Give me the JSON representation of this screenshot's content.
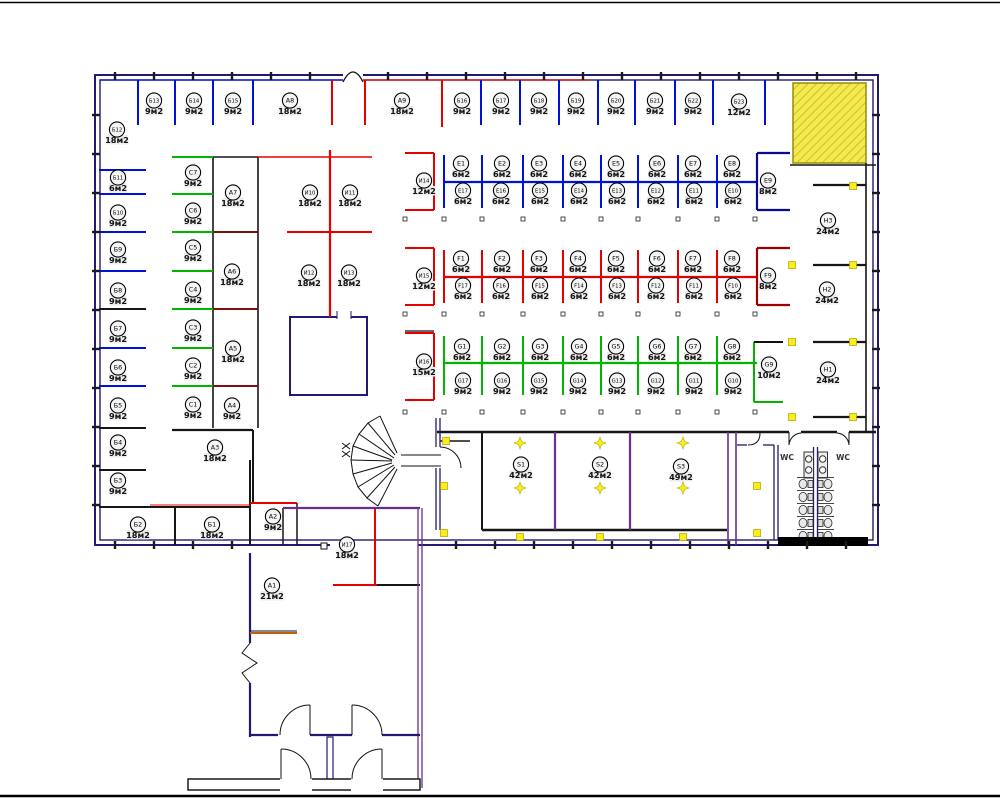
{
  "plan": {
    "wc_left_label": "WC",
    "wc_right_label": "WC",
    "colors": {
      "partition_blue": "#0012d8",
      "partition_red": "#e80000",
      "partition_green": "#00b400",
      "wall_navy": "#231a6f",
      "wall_purple": "#6b2d8f",
      "hatch_yellow": "#f2ea4e",
      "marker_yellow": "#f8ef18"
    },
    "rooms": [
      {
        "id": "Б13",
        "area": "9м2"
      },
      {
        "id": "Б14",
        "area": "9м2"
      },
      {
        "id": "Б15",
        "area": "9м2"
      },
      {
        "id": "A8",
        "area": "18м2"
      },
      {
        "id": "A9",
        "area": "18м2"
      },
      {
        "id": "Б16",
        "area": "9м2"
      },
      {
        "id": "Б17",
        "area": "9м2"
      },
      {
        "id": "Б18",
        "area": "9м2"
      },
      {
        "id": "Б19",
        "area": "9м2"
      },
      {
        "id": "Б20",
        "area": "9м2"
      },
      {
        "id": "Б21",
        "area": "9м2"
      },
      {
        "id": "Б22",
        "area": "9м2"
      },
      {
        "id": "Б23",
        "area": "12м2"
      },
      {
        "id": "Б12",
        "area": "18м2"
      },
      {
        "id": "Б11",
        "area": "6м2"
      },
      {
        "id": "Б10",
        "area": "9м2"
      },
      {
        "id": "Б9",
        "area": "9м2"
      },
      {
        "id": "Б8",
        "area": "9м2"
      },
      {
        "id": "Б7",
        "area": "9м2"
      },
      {
        "id": "Б6",
        "area": "9м2"
      },
      {
        "id": "Б5",
        "area": "9м2"
      },
      {
        "id": "Б4",
        "area": "9м2"
      },
      {
        "id": "Б3",
        "area": "9м2"
      },
      {
        "id": "Б2",
        "area": "18м2"
      },
      {
        "id": "Б1",
        "area": "18м2"
      },
      {
        "id": "C7",
        "area": "9м2"
      },
      {
        "id": "C6",
        "area": "9м2"
      },
      {
        "id": "C5",
        "area": "9м2"
      },
      {
        "id": "C4",
        "area": "9м2"
      },
      {
        "id": "C3",
        "area": "9м2"
      },
      {
        "id": "C2",
        "area": "9м2"
      },
      {
        "id": "C1",
        "area": "9м2"
      },
      {
        "id": "A7",
        "area": "18м2"
      },
      {
        "id": "A6",
        "area": "18м2"
      },
      {
        "id": "A5",
        "area": "18м2"
      },
      {
        "id": "A4",
        "area": "9м2"
      },
      {
        "id": "A3",
        "area": "18м2"
      },
      {
        "id": "A2",
        "area": "9м2"
      },
      {
        "id": "A1",
        "area": "21м2"
      },
      {
        "id": "И10",
        "area": "18м2"
      },
      {
        "id": "И11",
        "area": "18м2"
      },
      {
        "id": "И12",
        "area": "18м2"
      },
      {
        "id": "И13",
        "area": "18м2"
      },
      {
        "id": "И14",
        "area": "12м2"
      },
      {
        "id": "И15",
        "area": "12м2"
      },
      {
        "id": "И16",
        "area": "15м2"
      },
      {
        "id": "И17",
        "area": "18м2"
      },
      {
        "id": "E1",
        "area": "6м2"
      },
      {
        "id": "E2",
        "area": "6м2"
      },
      {
        "id": "E3",
        "area": "6м2"
      },
      {
        "id": "E4",
        "area": "6м2"
      },
      {
        "id": "E5",
        "area": "6м2"
      },
      {
        "id": "E6",
        "area": "6м2"
      },
      {
        "id": "E7",
        "area": "6м2"
      },
      {
        "id": "E8",
        "area": "6м2"
      },
      {
        "id": "E9",
        "area": "8м2"
      },
      {
        "id": "E17",
        "area": "6м2"
      },
      {
        "id": "E16",
        "area": "6м2"
      },
      {
        "id": "E15",
        "area": "6м2"
      },
      {
        "id": "E14",
        "area": "6м2"
      },
      {
        "id": "E13",
        "area": "6м2"
      },
      {
        "id": "E12",
        "area": "6м2"
      },
      {
        "id": "E11",
        "area": "6м2"
      },
      {
        "id": "E10",
        "area": "6м2"
      },
      {
        "id": "F1",
        "area": "6м2"
      },
      {
        "id": "F2",
        "area": "6м2"
      },
      {
        "id": "F3",
        "area": "6м2"
      },
      {
        "id": "F4",
        "area": "6м2"
      },
      {
        "id": "F5",
        "area": "6м2"
      },
      {
        "id": "F6",
        "area": "6м2"
      },
      {
        "id": "F7",
        "area": "6м2"
      },
      {
        "id": "F8",
        "area": "6м2"
      },
      {
        "id": "F9",
        "area": "8м2"
      },
      {
        "id": "F17",
        "area": "6м2"
      },
      {
        "id": "F16",
        "area": "6м2"
      },
      {
        "id": "F15",
        "area": "6м2"
      },
      {
        "id": "F14",
        "area": "6м2"
      },
      {
        "id": "F13",
        "area": "6м2"
      },
      {
        "id": "F12",
        "area": "6м2"
      },
      {
        "id": "F11",
        "area": "6м2"
      },
      {
        "id": "F10",
        "area": "6м2"
      },
      {
        "id": "G1",
        "area": "6м2"
      },
      {
        "id": "G2",
        "area": "6м2"
      },
      {
        "id": "G3",
        "area": "6м2"
      },
      {
        "id": "G4",
        "area": "6м2"
      },
      {
        "id": "G5",
        "area": "6м2"
      },
      {
        "id": "G6",
        "area": "6м2"
      },
      {
        "id": "G7",
        "area": "6м2"
      },
      {
        "id": "G8",
        "area": "6м2"
      },
      {
        "id": "G9",
        "area": "10м2"
      },
      {
        "id": "G17",
        "area": "9м2"
      },
      {
        "id": "G16",
        "area": "9м2"
      },
      {
        "id": "G15",
        "area": "9м2"
      },
      {
        "id": "G14",
        "area": "9м2"
      },
      {
        "id": "G13",
        "area": "9м2"
      },
      {
        "id": "G12",
        "area": "9м2"
      },
      {
        "id": "G11",
        "area": "9м2"
      },
      {
        "id": "G10",
        "area": "9м2"
      },
      {
        "id": "H3",
        "area": "24м2"
      },
      {
        "id": "H2",
        "area": "24м2"
      },
      {
        "id": "H1",
        "area": "24м2"
      },
      {
        "id": "S1",
        "area": "42м2"
      },
      {
        "id": "S2",
        "area": "42м2"
      },
      {
        "id": "S3",
        "area": "49м2"
      }
    ]
  }
}
